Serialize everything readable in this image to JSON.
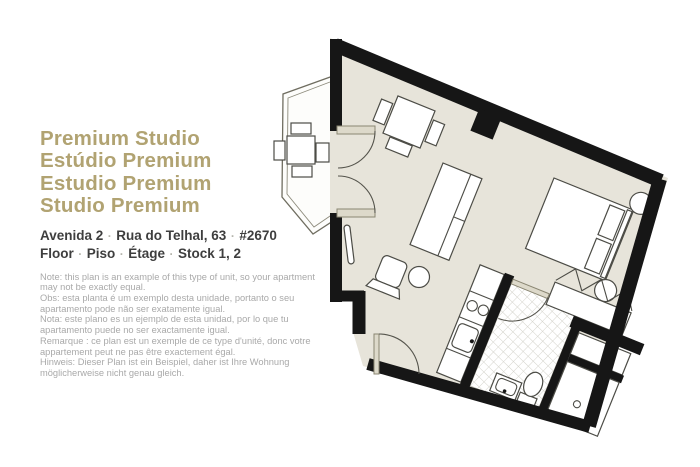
{
  "title": {
    "lines": [
      "Premium Studio",
      "Estúdio Premium",
      "Estudio Premium",
      "Studio Premium"
    ]
  },
  "address": {
    "separator": "·",
    "line1_parts": [
      "Avenida 2",
      "Rua do Telhal, 63",
      "#2670"
    ],
    "line2_parts": [
      "Floor",
      "Piso",
      "Étage",
      "Stock 1, 2"
    ]
  },
  "notes": [
    "Note: this plan is an example of this type of unit, so your apartment may not be exactly equal.",
    "Obs: esta planta é um exemplo desta unidade, portanto o seu apartamento pode não ser exatamente igual.",
    "Nota: este plano es un ejemplo de esta unidad, por lo que tu apartamento puede no ser exactamente igual.",
    "Remarque : ce plan est un exemple de ce type d'unité, donc votre appartement peut ne pas être exactement égal.",
    "Hinweis: Dieser Plan ist ein Beispiel, daher ist Ihre Wohnung möglicherweise nicht genau gleich."
  ],
  "colors": {
    "wall_color": "#161616",
    "floor_color": "#e7e4da",
    "line_color": "#4c4c46",
    "deck_line_color": "#c9c6ba",
    "tile_line_color": "#d2d1c9",
    "door_color": "#ddd9ca",
    "title_color": "#b1a372",
    "address_color": "#3e3e3e",
    "note_color": "#a9a9a9",
    "separator_color": "#b5b5ad"
  }
}
